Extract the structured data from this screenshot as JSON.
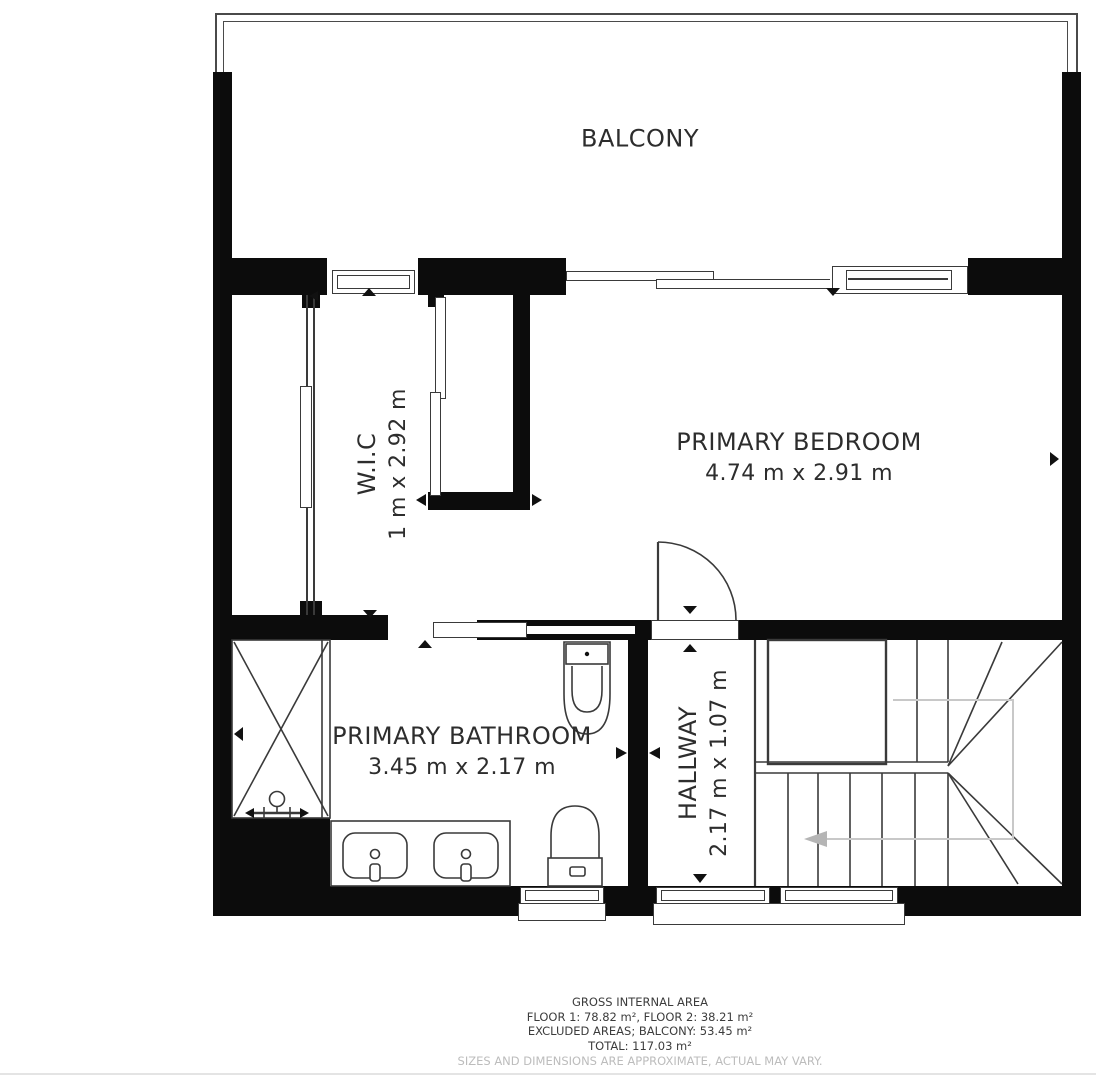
{
  "rooms": {
    "balcony": {
      "label": "BALCONY"
    },
    "wic": {
      "label": "W.I.C",
      "dims": "1 m x 2.92 m"
    },
    "bedroom": {
      "label": "PRIMARY BEDROOM",
      "dims": "4.74 m x 2.91 m"
    },
    "bathroom": {
      "label": "PRIMARY BATHROOM",
      "dims": "3.45 m x 2.17 m"
    },
    "hallway": {
      "label": "HALLWAY",
      "dims": "2.17 m x 1.07 m"
    }
  },
  "footer": {
    "line1": "GROSS INTERNAL AREA",
    "line2": "FLOOR 1: 78.82 m², FLOOR 2: 38.21 m²",
    "line3": "EXCLUDED AREAS; BALCONY: 53.45 m²",
    "line4": "TOTAL: 117.03 m²",
    "disclaimer": "SIZES AND DIMENSIONS ARE APPROXIMATE, ACTUAL MAY VARY."
  },
  "colors": {
    "wall": "#0c0c0c",
    "line": "#3a3a3a",
    "text": "#2d2d2d",
    "stair_arrow": "#b5b5b5",
    "disclaimer_text": "#bcbcbc"
  }
}
